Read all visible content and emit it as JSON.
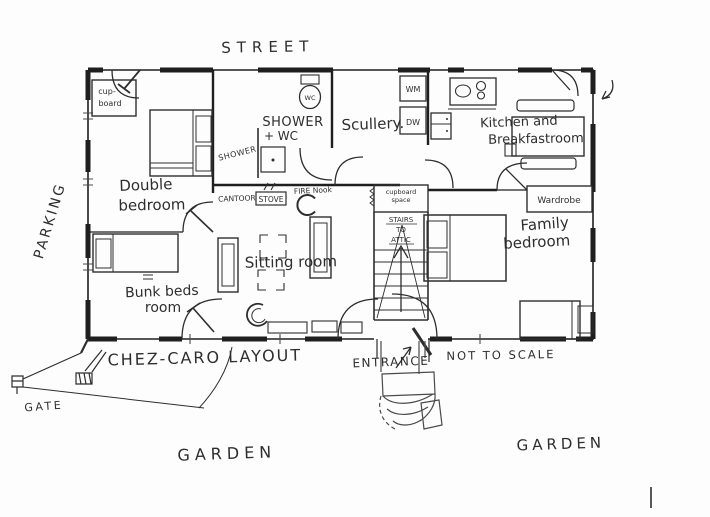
{
  "colors": {
    "ink": "#2e2e2e",
    "wall": "#1f1f1f",
    "paper": "#fdfdfd"
  },
  "title": "CHEZ-CARO LAYOUT",
  "annotations": {
    "street": "STREET",
    "parking": "PARKING",
    "garden_left": "GARDEN",
    "garden_right": "GARDEN",
    "gate": "GATE",
    "entrance": "ENTRANCE",
    "not_to_scale": "NOT TO SCALE"
  },
  "rooms": {
    "double_bedroom": {
      "line1": "Double",
      "line2": "bedroom"
    },
    "bunk_beds_room": {
      "line1": "Bunk beds",
      "line2": "room"
    },
    "sitting_room": {
      "label": "Sitting room"
    },
    "shower_wc": {
      "line1": "SHOWER",
      "line2": "+ WC"
    },
    "scullery": {
      "label": "Scullery."
    },
    "kitchen_breakfast": {
      "line1": "Kitchen and",
      "line2": "Breakfastroom"
    },
    "family_bedroom": {
      "line1": "Family",
      "line2": "bedroom"
    }
  },
  "fixtures": {
    "cupboard": {
      "line1": "cup-",
      "line2": "board"
    },
    "shower": "SHOWER",
    "wc": "WC",
    "cantoor": "CANTOOR",
    "stove": "STOVE",
    "fire_nook": "FIRE Nook",
    "cupboard_space": {
      "line1": "cupboard",
      "line2": "space"
    },
    "stairs_to_attic": {
      "line1": "STAIRS",
      "line2": "TO",
      "line3": "ATTIC"
    },
    "washing_machine": "WM",
    "dishwasher": "DW",
    "wardrobe": "Wardrobe"
  }
}
